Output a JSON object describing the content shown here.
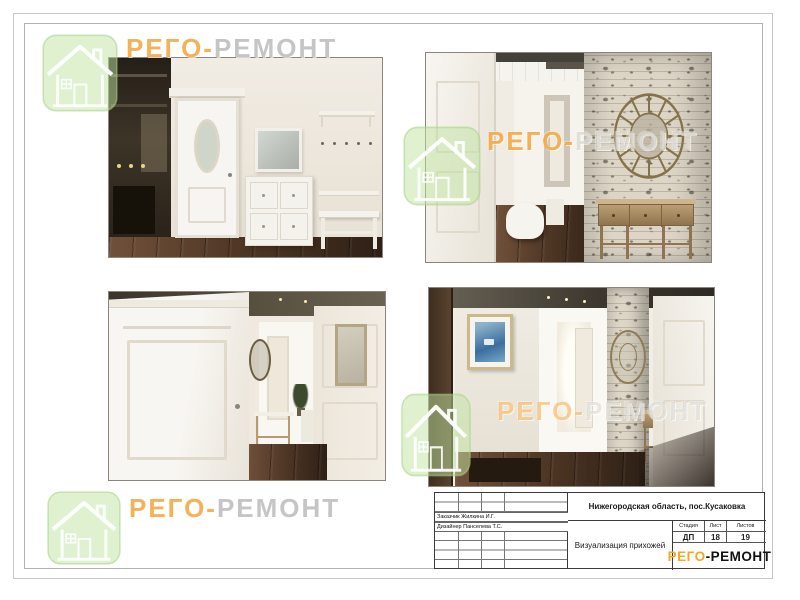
{
  "brand": {
    "watermark_prefix": "РЕГО-",
    "watermark_suffix": "РЕМОНТ",
    "logo_prefix": "РЕГО",
    "logo_suffix": "-РЕМОНТ",
    "accent_orange": "#f5a623",
    "logo_green": "#bfe3a0"
  },
  "title_block": {
    "client": "Заказчик Жилкина И.Г.",
    "designer": "Дизайнер Панселева Т.С.",
    "location": "Нижегородская область, пос.Кусаковка",
    "drawing_title": "Визуализация прихожей",
    "stage_label": "Стадия",
    "sheet_label": "Лист",
    "sheets_label": "Листов",
    "stage_value": "ДП",
    "sheet_value": "18",
    "sheets_value": "19"
  }
}
